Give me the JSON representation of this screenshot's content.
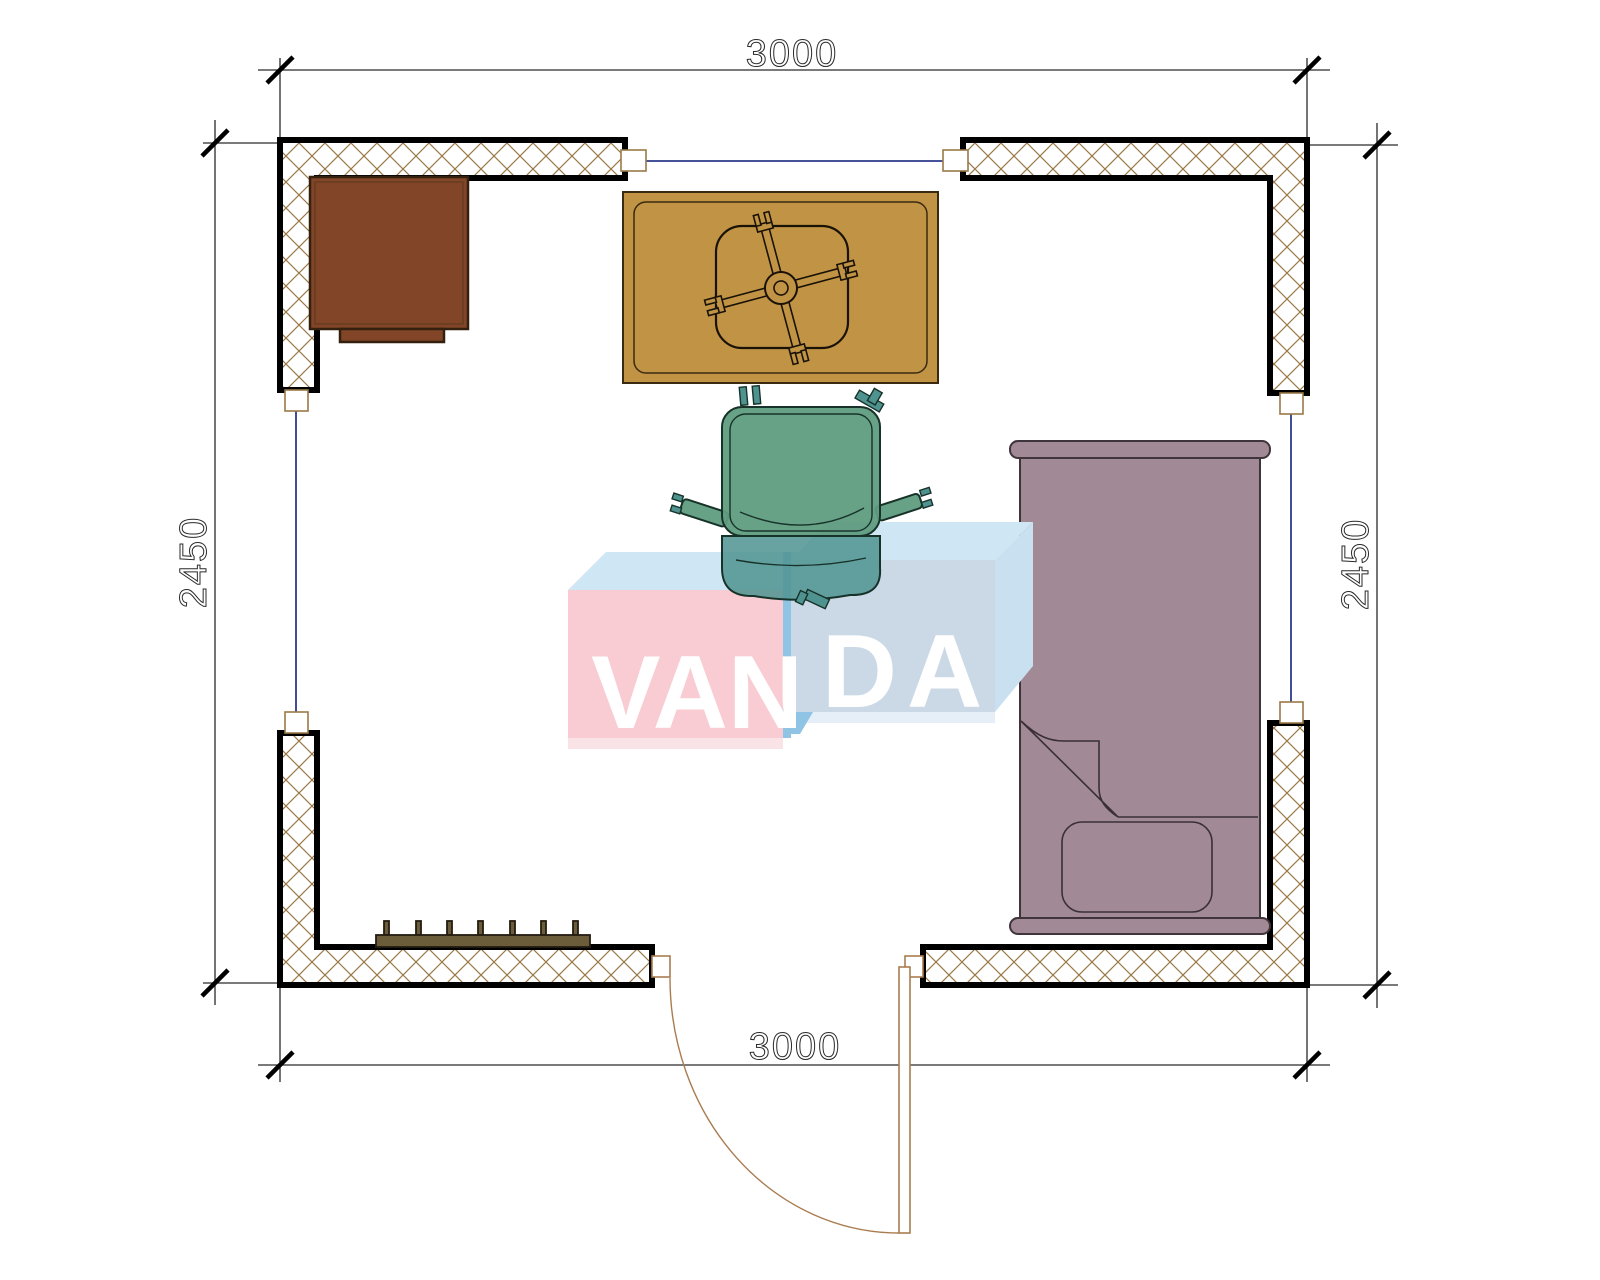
{
  "scene": {
    "type": "room-floor-plan"
  },
  "dimensions": {
    "top": "3000",
    "bottom": "3000",
    "left": "2450",
    "right": "2450"
  },
  "watermark": {
    "left": "VAN",
    "right": "DA",
    "full": "VANDA"
  },
  "furniture": [
    "cabinet-icon",
    "table-icon",
    "office-chair-icon",
    "armchair-icon",
    "single-bed-icon",
    "pillow-icon",
    "radiator-icon",
    "door-icon",
    "window-icon"
  ],
  "colors": {
    "page_bg": "#ffffff",
    "dim_line": "#2a2a2a",
    "hatch": "#9a7947",
    "window_line": "#2b3a8c",
    "cabinet": "#824527",
    "table": "#c09444",
    "chair_seat": "#5f9c80",
    "chair_back": "#4f9390",
    "bed": "#a18a95",
    "radiator": "#6b5c3a",
    "door": "#a97c50",
    "logo_pink": "#f8ccd2",
    "logo_front": "#cbd9e7",
    "logo_top": "#cfe7f4",
    "logo_side": "#c9e0f1",
    "logo_strip": "#8fc4e4",
    "logo_text": "#ffffff"
  }
}
